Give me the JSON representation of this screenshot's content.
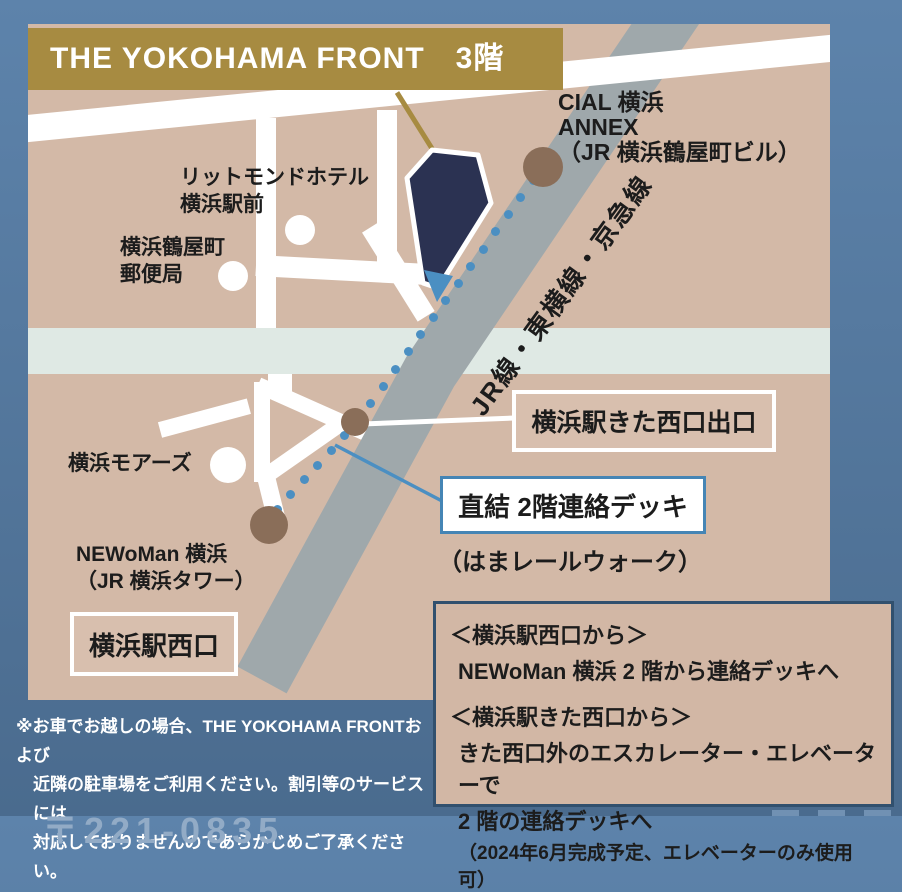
{
  "banner": {
    "title": "THE YOKOHAMA FRONT　3階"
  },
  "map": {
    "railway_label": "JR線・東横線・京急線",
    "labels": {
      "hotel": "リットモンドホテル\n横浜駅前",
      "post_office": "横浜鶴屋町\n郵便局",
      "cial": "CIAL 横浜\nANNEX\n（JR 横浜鶴屋町ビル）",
      "moas": "横浜モアーズ",
      "newoman": "NEWoMan 横浜\n（JR 横浜タワー）",
      "west_exit": "横浜駅西口",
      "kita_west_exit": "横浜駅きた西口出口",
      "deck": "直結 2階連絡デッキ",
      "hama_rail_walk": "（はまレールウォーク）"
    },
    "path_dots": [
      [
        505,
        156
      ],
      [
        492,
        173
      ],
      [
        480,
        190
      ],
      [
        467,
        207
      ],
      [
        455,
        225
      ],
      [
        442,
        242
      ],
      [
        430,
        259
      ],
      [
        417,
        276
      ],
      [
        405,
        293
      ],
      [
        392,
        310
      ],
      [
        380,
        327
      ],
      [
        367,
        345
      ],
      [
        355,
        362
      ],
      [
        342,
        379
      ],
      [
        330,
        396
      ],
      [
        316,
        411
      ],
      [
        303,
        426
      ],
      [
        289,
        441
      ],
      [
        276,
        455
      ],
      [
        262,
        470
      ],
      [
        249,
        485
      ]
    ]
  },
  "info_box": {
    "lines": [
      "＜横浜駅西口から＞",
      "NEWoMan 横浜 2 階から連絡デッキへ",
      "＜横浜駅きた西口から＞",
      "きた西口外のエスカレーター・エレベーターで",
      "2 階の連絡デッキへ",
      "（2024年6月完成予定、エレベーターのみ使用可）"
    ]
  },
  "note": {
    "lines": [
      "※お車でお越しの場合、THE YOKOHAMA FRONTおよび",
      "近隣の駐車場をご利用ください。割引等のサービスには",
      "対応しておりませんのであらかじめご了承ください。"
    ]
  },
  "footer_partial": "〒221-0835",
  "colors": {
    "background_top": "#5d83ab",
    "background_bottom": "#4a6b8e",
    "map_bg": "#d3b9a7",
    "road": "#ffffff",
    "railway": "#9fa8ab",
    "river_band": "#dfe9e4",
    "banner_gold": "#a78b41",
    "building_navy": "#2b3252",
    "marker_brown": "#8a6e59",
    "route_blue": "#4b8fc2",
    "info_border_navy": "#31506e",
    "text": "#1c1c1c"
  }
}
